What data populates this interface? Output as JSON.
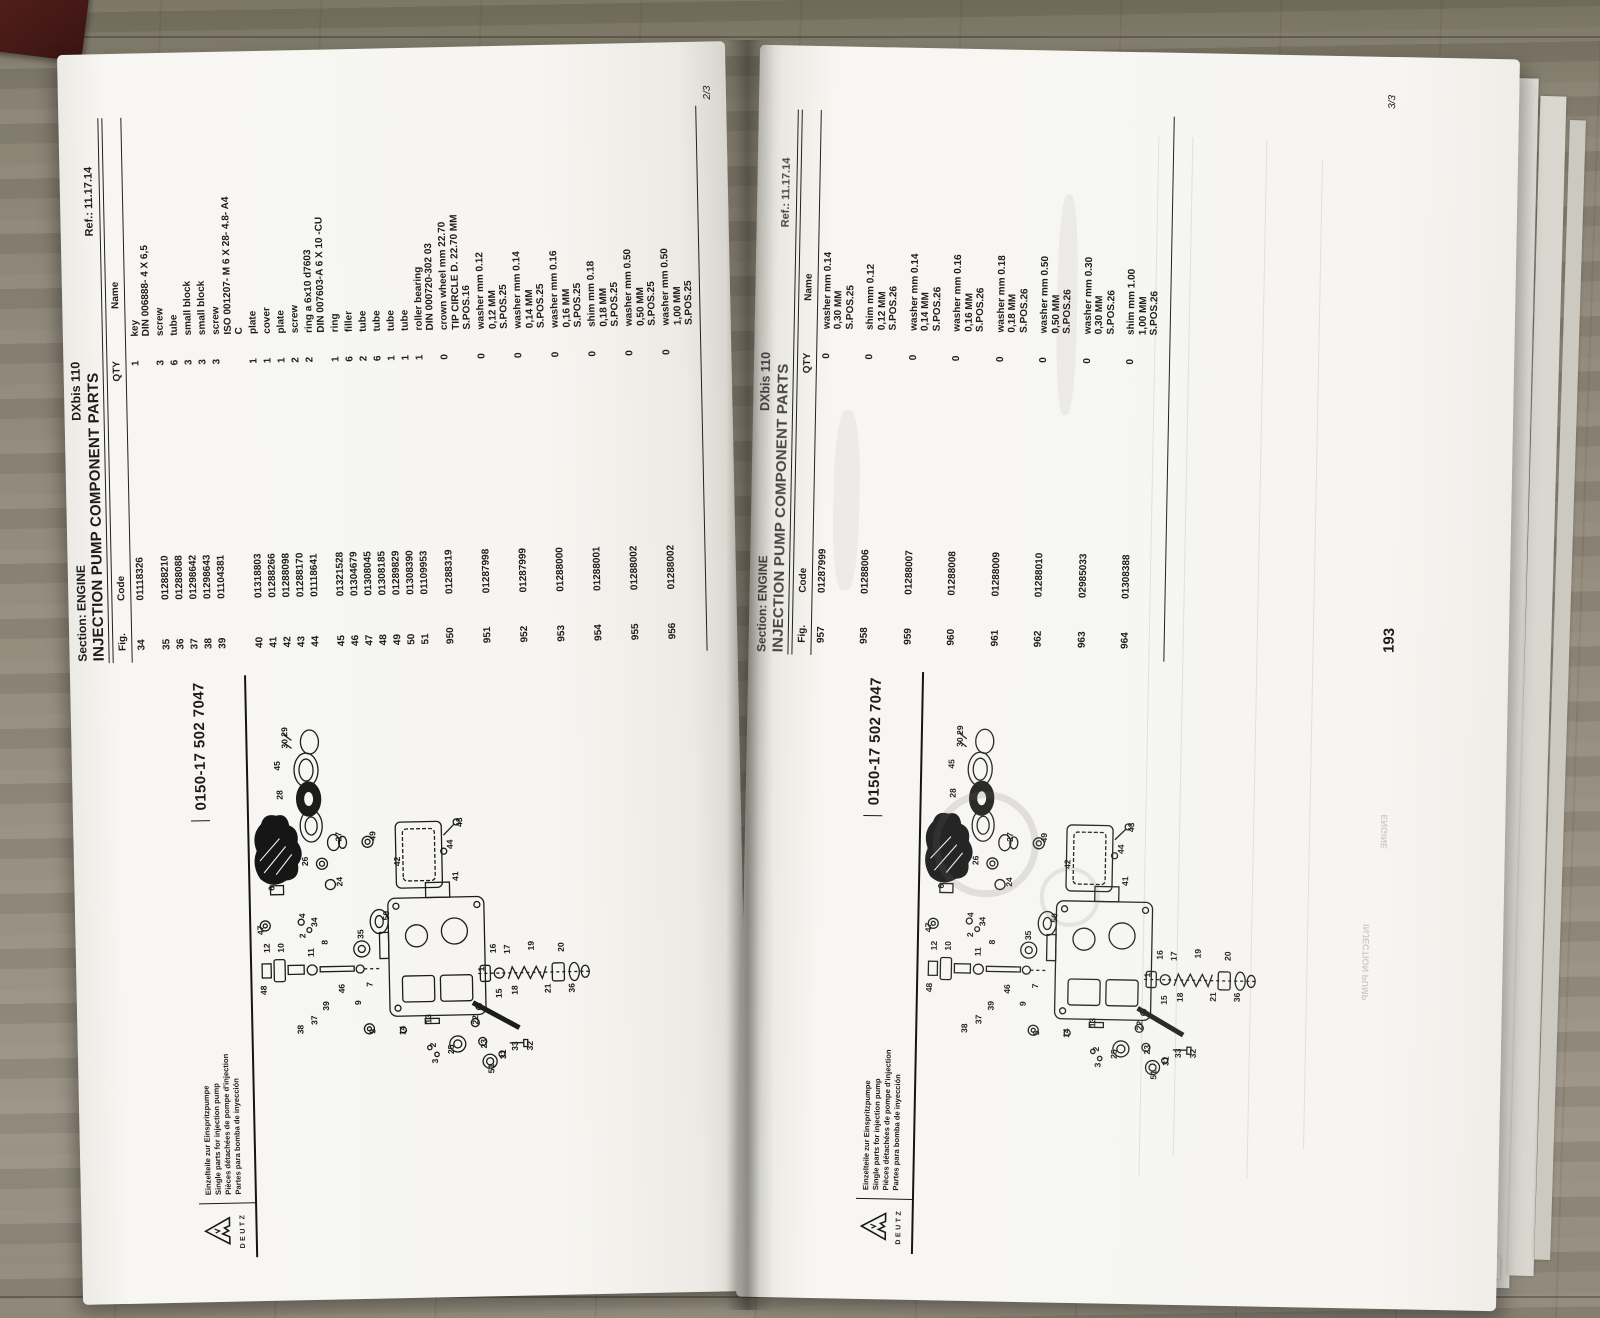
{
  "palette": {
    "paper": "#f6f5f1",
    "ink": "#1d1c1b",
    "wood": "#8a8374",
    "spine_shadow": "#14120e",
    "red_object": "#441a16"
  },
  "header": {
    "section": "Section: ENGINE",
    "title": "INJECTION PUMP COMPONENT PARTS",
    "model": "DXbis 110",
    "ref": "Ref.: 11.17.14"
  },
  "table_columns": [
    "Fig.",
    "Code",
    "QTY",
    "Name"
  ],
  "left_page": {
    "sheet": "2/3",
    "rows": [
      {
        "fig": "34",
        "code": "01118326",
        "qty": "1",
        "name": [
          "key",
          "DIN 006888- 4 X 6,5"
        ]
      },
      {
        "fig": "35",
        "code": "01288210",
        "qty": "3",
        "name": [
          "screw"
        ]
      },
      {
        "fig": "36",
        "code": "01288088",
        "qty": "6",
        "name": [
          "tube"
        ]
      },
      {
        "fig": "37",
        "code": "01298642",
        "qty": "3",
        "name": [
          "small block"
        ]
      },
      {
        "fig": "38",
        "code": "01298643",
        "qty": "3",
        "name": [
          "small block"
        ]
      },
      {
        "fig": "39",
        "code": "01104381",
        "qty": "3",
        "name": [
          "screw",
          "ISO 001207- M 6 X 28- 4.8- A4",
          "C"
        ]
      },
      {
        "fig": "40",
        "code": "01318803",
        "qty": "1",
        "name": [
          "plate"
        ]
      },
      {
        "fig": "41",
        "code": "01288266",
        "qty": "1",
        "name": [
          "cover"
        ]
      },
      {
        "fig": "42",
        "code": "01288098",
        "qty": "1",
        "name": [
          "plate"
        ]
      },
      {
        "fig": "43",
        "code": "01288170",
        "qty": "2",
        "name": [
          "screw"
        ]
      },
      {
        "fig": "44",
        "code": "01118641",
        "qty": "2",
        "name": [
          "ring a 6x10 d7603",
          "DIN 007603-A 6 X 10 -CU"
        ]
      },
      {
        "fig": "45",
        "code": "01321528",
        "qty": "1",
        "name": [
          "ring"
        ]
      },
      {
        "fig": "46",
        "code": "01304679",
        "qty": "6",
        "name": [
          "filler"
        ]
      },
      {
        "fig": "47",
        "code": "01308045",
        "qty": "2",
        "name": [
          "tube"
        ]
      },
      {
        "fig": "48",
        "code": "01308185",
        "qty": "6",
        "name": [
          "tube"
        ]
      },
      {
        "fig": "49",
        "code": "01289829",
        "qty": "1",
        "name": [
          "tube"
        ]
      },
      {
        "fig": "50",
        "code": "01308390",
        "qty": "1",
        "name": [
          "tube"
        ]
      },
      {
        "fig": "51",
        "code": "01109953",
        "qty": "1",
        "name": [
          "roller bearing",
          "DIN 000720-302 03"
        ]
      },
      {
        "fig": "950",
        "code": "01288319",
        "qty": "0",
        "name": [
          "crown wheel mm 22.70",
          "TIP CIRCLE D. 22.70 MM",
          "S.POS.16"
        ]
      },
      {
        "fig": "951",
        "code": "01287998",
        "qty": "0",
        "name": [
          "washer mm 0.12",
          "0,12 MM",
          "S.POS.25"
        ]
      },
      {
        "fig": "952",
        "code": "01287999",
        "qty": "0",
        "name": [
          "washer mm 0.14",
          "0,14 MM",
          "S.POS.25"
        ]
      },
      {
        "fig": "953",
        "code": "01288000",
        "qty": "0",
        "name": [
          "washer mm 0.16",
          "0,16 MM",
          "S.POS.25"
        ]
      },
      {
        "fig": "954",
        "code": "01288001",
        "qty": "0",
        "name": [
          "shim mm 0.18",
          "0,18 MM",
          "S.POS.25"
        ]
      },
      {
        "fig": "955",
        "code": "01288002",
        "qty": "0",
        "name": [
          "washer mm 0.50",
          "0,50 MM",
          "S.POS.25"
        ]
      },
      {
        "fig": "956",
        "code": "01288002",
        "qty": "0",
        "name": [
          "washer mm 0.50",
          "1,00 MM",
          "S.POS.25"
        ]
      }
    ]
  },
  "right_page": {
    "sheet": "3/3",
    "page_number": "193",
    "rows": [
      {
        "fig": "957",
        "code": "01287999",
        "qty": "0",
        "name": [
          "washer mm 0.14",
          "0,30 MM",
          "S.POS.25"
        ]
      },
      {
        "fig": "958",
        "code": "01288006",
        "qty": "0",
        "name": [
          "shim mm 0.12",
          "0,12 MM",
          "S.POS.26"
        ]
      },
      {
        "fig": "959",
        "code": "01288007",
        "qty": "0",
        "name": [
          "washer mm 0.14",
          "0,14 MM",
          "S.POS.26"
        ]
      },
      {
        "fig": "960",
        "code": "01288008",
        "qty": "0",
        "name": [
          "washer mm 0.16",
          "0,16 MM",
          "S.POS.26"
        ]
      },
      {
        "fig": "961",
        "code": "01288009",
        "qty": "0",
        "name": [
          "washer mm 0.18",
          "0,18 MM",
          "S.POS.26"
        ]
      },
      {
        "fig": "962",
        "code": "01288010",
        "qty": "0",
        "name": [
          "washer mm 0.50",
          "0,50 MM",
          "S.POS.26"
        ]
      },
      {
        "fig": "963",
        "code": "02985033",
        "qty": "0",
        "name": [
          "washer mm 0.30",
          "0,30 MM",
          "S.POS.26"
        ]
      },
      {
        "fig": "964",
        "code": "01308388",
        "qty": "0",
        "name": [
          "shim mm 1.00",
          "1,00 MM",
          "S.POS.26"
        ]
      }
    ]
  },
  "diagram": {
    "part_number": "0150-17 502 7047",
    "brand": "DEUTZ",
    "languages": [
      "Einzelteile zur Einspritzpumpe",
      "Single parts for injection pump",
      "Pièces détachées de pompe d'injection",
      "Partes para bomba de inyección"
    ],
    "callouts": [
      {
        "n": "48",
        "x": 262,
        "y": 14
      },
      {
        "n": "12",
        "x": 304,
        "y": 18
      },
      {
        "n": "10",
        "x": 304,
        "y": 32
      },
      {
        "n": "38",
        "x": 222,
        "y": 50
      },
      {
        "n": "37",
        "x": 231,
        "y": 64
      },
      {
        "n": "39",
        "x": 245,
        "y": 76
      },
      {
        "n": "46",
        "x": 262,
        "y": 92
      },
      {
        "n": "11",
        "x": 299,
        "y": 62
      },
      {
        "n": "8",
        "x": 311,
        "y": 76
      },
      {
        "n": "9",
        "x": 250,
        "y": 108
      },
      {
        "n": "7",
        "x": 268,
        "y": 120
      },
      {
        "n": "47",
        "x": 322,
        "y": 12
      },
      {
        "n": "6",
        "x": 366,
        "y": 24
      },
      {
        "n": "4",
        "x": 338,
        "y": 54
      },
      {
        "n": "34",
        "x": 329,
        "y": 66
      },
      {
        "n": "2",
        "x": 318,
        "y": 54
      },
      {
        "n": "30 29",
        "x": 508,
        "y": 40
      },
      {
        "n": "45",
        "x": 486,
        "y": 32
      },
      {
        "n": "28",
        "x": 457,
        "y": 34
      },
      {
        "n": "40",
        "x": 430,
        "y": 36
      },
      {
        "n": "26",
        "x": 390,
        "y": 58
      },
      {
        "n": "27",
        "x": 414,
        "y": 92
      },
      {
        "n": "24",
        "x": 369,
        "y": 92
      },
      {
        "n": "49",
        "x": 414,
        "y": 126
      },
      {
        "n": "42",
        "x": 388,
        "y": 150
      },
      {
        "n": "44",
        "x": 404,
        "y": 203
      },
      {
        "n": "43",
        "x": 426,
        "y": 213
      },
      {
        "n": "41",
        "x": 372,
        "y": 208
      },
      {
        "n": "50",
        "x": 334,
        "y": 138
      },
      {
        "n": "35",
        "x": 316,
        "y": 112
      },
      {
        "n": "1",
        "x": 281,
        "y": 232
      },
      {
        "n": "16",
        "x": 299,
        "y": 244
      },
      {
        "n": "17",
        "x": 298,
        "y": 258
      },
      {
        "n": "19",
        "x": 301,
        "y": 282
      },
      {
        "n": "20",
        "x": 299,
        "y": 312
      },
      {
        "n": "15",
        "x": 254,
        "y": 249
      },
      {
        "n": "18",
        "x": 257,
        "y": 265
      },
      {
        "n": "21",
        "x": 258,
        "y": 298
      },
      {
        "n": "36",
        "x": 258,
        "y": 322
      },
      {
        "n": "5",
        "x": 221,
        "y": 122
      },
      {
        "n": "14",
        "x": 219,
        "y": 152
      },
      {
        "n": "13",
        "x": 230,
        "y": 178
      },
      {
        "n": "2",
        "x": 206,
        "y": 182
      },
      {
        "n": "3",
        "x": 190,
        "y": 184
      },
      {
        "n": "22",
        "x": 228,
        "y": 225
      },
      {
        "n": "23",
        "x": 204,
        "y": 233
      },
      {
        "n": "25",
        "x": 199,
        "y": 200
      },
      {
        "n": "51",
        "x": 179,
        "y": 240
      },
      {
        "n": "31",
        "x": 193,
        "y": 252
      },
      {
        "n": "33",
        "x": 201,
        "y": 264
      },
      {
        "n": "32",
        "x": 201,
        "y": 279
      }
    ]
  },
  "ghost": {
    "line1": "INJECTION PUMP",
    "line2": "ENGINE"
  }
}
